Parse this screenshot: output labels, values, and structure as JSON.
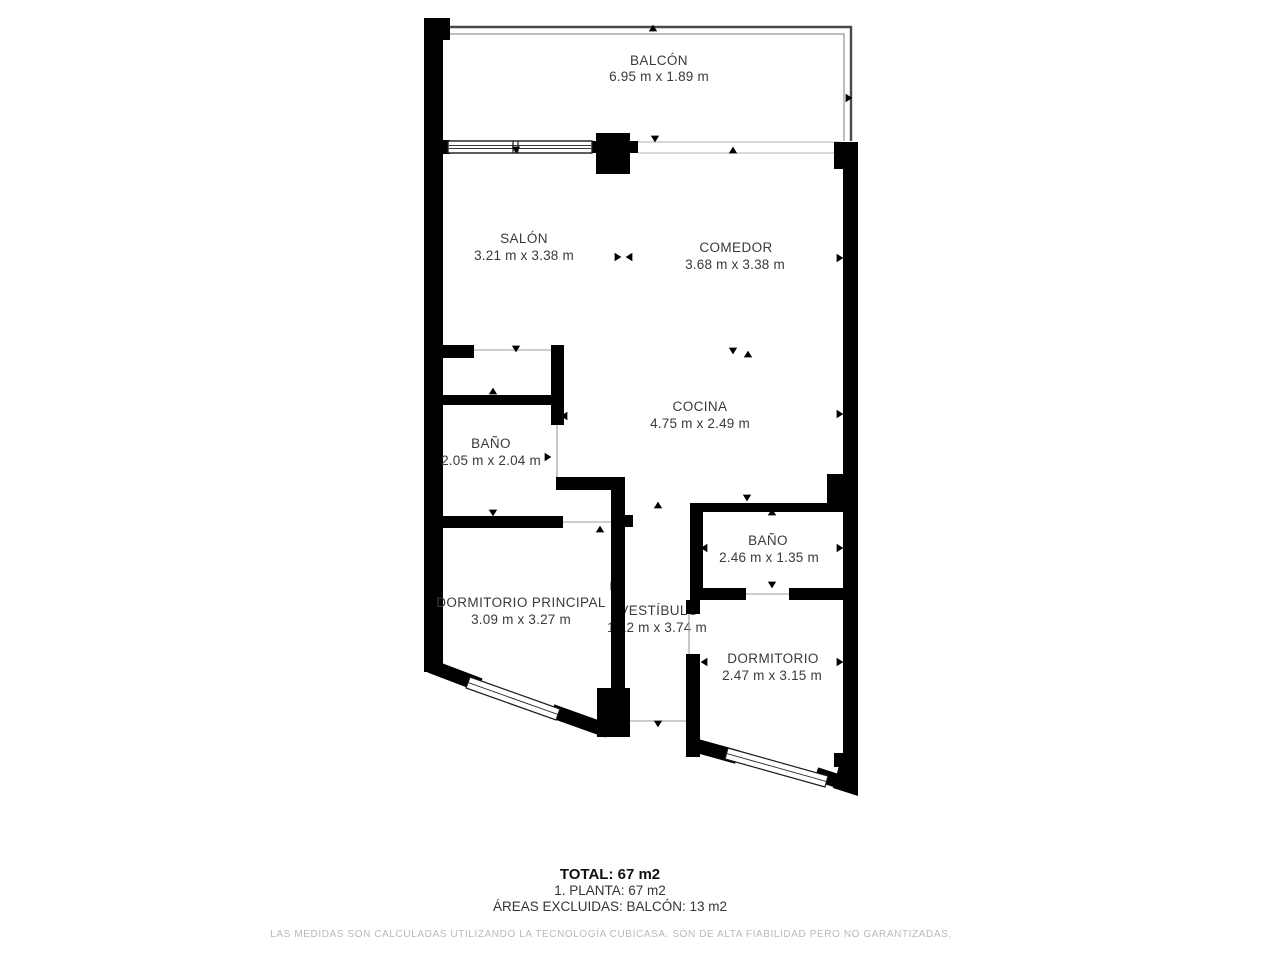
{
  "plan": {
    "rooms": {
      "balcon": {
        "name": "BALCÓN",
        "dims": "6.95 m x 1.89 m"
      },
      "salon": {
        "name": "SALÓN",
        "dims": "3.21 m x 3.38 m"
      },
      "comedor": {
        "name": "COMEDOR",
        "dims": "3.68 m x 3.38 m"
      },
      "cocina": {
        "name": "COCINA",
        "dims": "4.75 m x 2.49 m"
      },
      "bano1": {
        "name": "BAÑO",
        "dims": "2.05 m x 2.04 m"
      },
      "bano2": {
        "name": "BAÑO",
        "dims": "2.46 m x 1.35 m"
      },
      "dormitorio_principal": {
        "name": "DORMITORIO PRINCIPAL",
        "dims": "3.09 m x 3.27 m"
      },
      "vestibulo": {
        "name": "VESTÍBULO",
        "dims": "1.12 m x 3.74 m"
      },
      "dormitorio": {
        "name": "DORMITORIO",
        "dims": "2.47 m x 3.15 m"
      }
    },
    "colors": {
      "wall": "#000000",
      "label": "#3a3a3a",
      "railing_outer": "#4a4a4a",
      "railing_inner": "#9a9a9a",
      "opening_line": "#9b9b9b",
      "disclaimer": "#b9b9b9"
    }
  },
  "summary": {
    "total": "TOTAL: 67 m2",
    "floor": "1. PLANTA: 67 m2",
    "excluded": "ÁREAS EXCLUIDAS: BALCÓN: 13 m2",
    "disclaimer": "LAS MEDIDAS SON CALCULADAS UTILIZANDO LA TECNOLOGÍA CUBICASA. SON DE ALTA FIABILIDAD PERO NO GARANTIZADAS."
  }
}
